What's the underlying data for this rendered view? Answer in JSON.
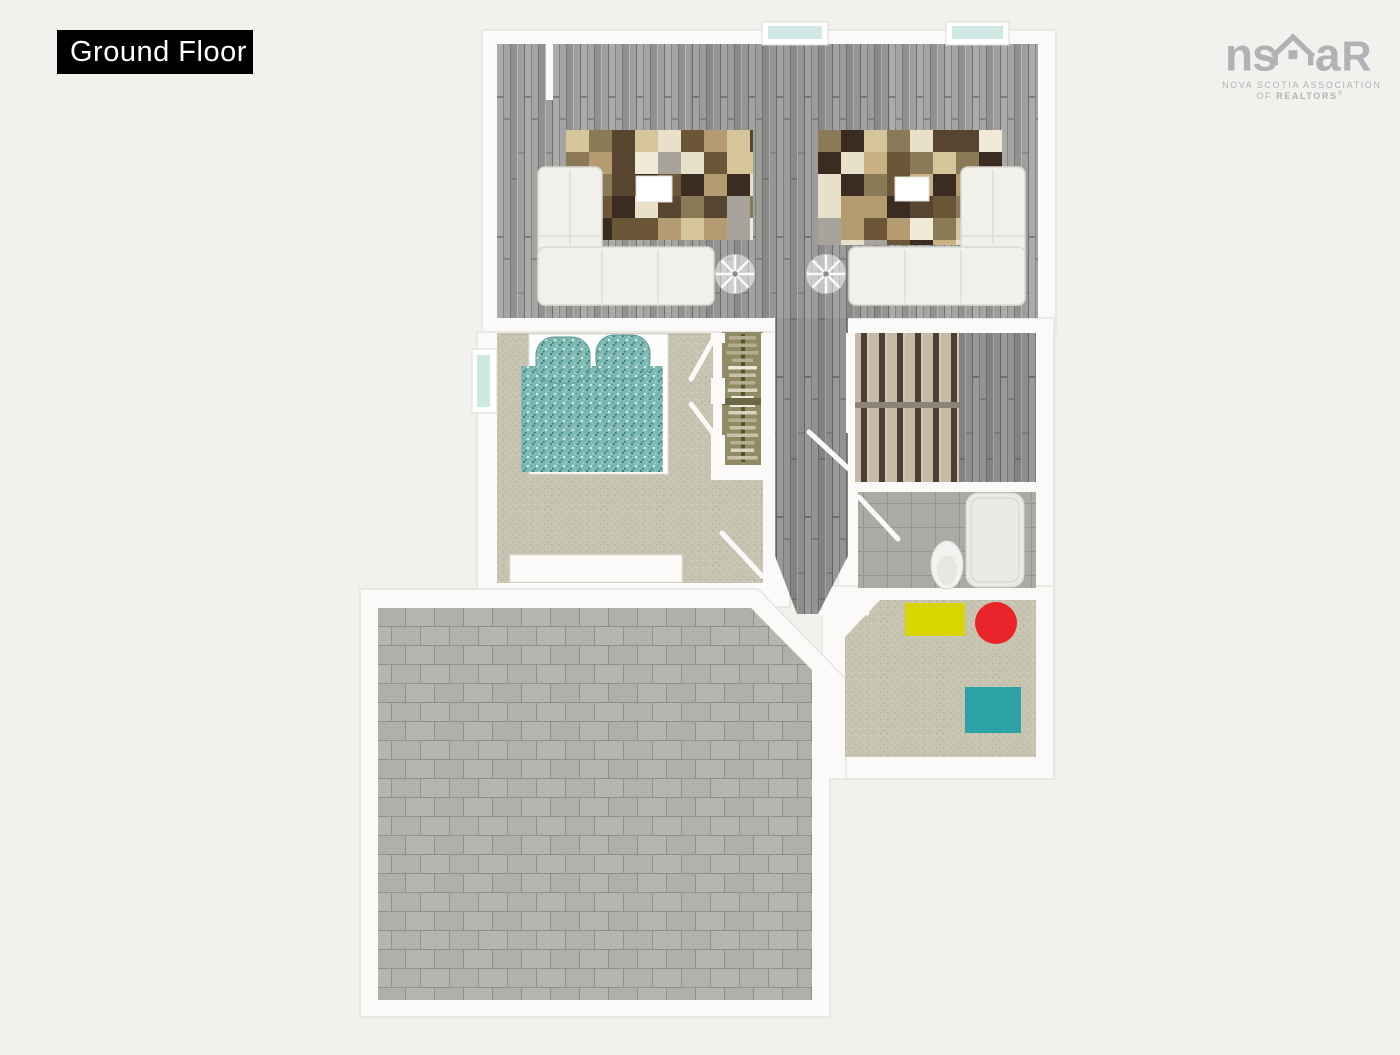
{
  "title_badge": {
    "label": "Ground Floor"
  },
  "logo": {
    "left": "ns",
    "a": "a",
    "r": "R",
    "line1": "NOVA SCOTIA ASSOCIATION",
    "line2_prefix": "OF ",
    "line2_bold": "REALTORS",
    "registered": "®"
  },
  "colors": {
    "badge_bg": "#000000",
    "badge_text": "#ffffff",
    "logo_gray": "#b2b1b5",
    "background": "#f3f1ee",
    "wall": "#fbfaf8",
    "wall_edge": "#e5e3df",
    "wood_base": "#9c9c9a",
    "carpet": "#c7c4b2",
    "closet_floor": "#8f8c63",
    "bathroom_tile": "#abaaa5",
    "paver_gray": "#b5b4af",
    "stair_tread": "#c6b9a6",
    "stair_gap": "#4b4036",
    "bed_teal": "#7fb9b4",
    "window_glass": "#cfe8e4",
    "sofa_white": "#f1f0ea",
    "mat_yellow": "#d8d500",
    "pouf_red": "#e8232a",
    "stool_teal": "#2ba2a6"
  },
  "rug_palette": [
    "#3a2c20",
    "#e8e0c8",
    "#b49b72",
    "#a8a49c",
    "#8a7a58",
    "#6b5638",
    "#d6c49a",
    "#efe9d6",
    "#57452f",
    "#c9b184"
  ],
  "hanger_palette": [
    "#d8d2be",
    "#efeadb",
    "#b5ae93",
    "#c9c2a8"
  ]
}
